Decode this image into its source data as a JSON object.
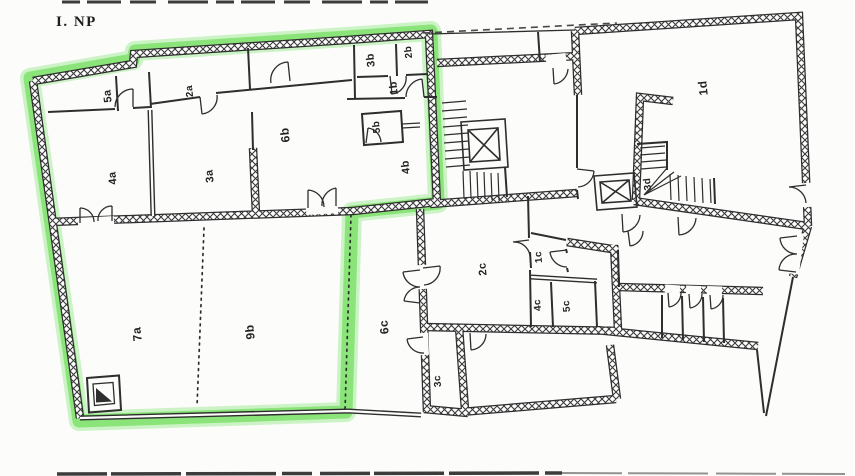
{
  "page": {
    "title": "I. NP"
  },
  "colors": {
    "paper": "#fcfcfb",
    "wall_ink": "#2e2e2e",
    "highlight_marker": "#7ee06b"
  },
  "symbols": {
    "elevator": "box-with-x",
    "stairs": "tread-lines",
    "door": "quarter-arc",
    "unit_boundary": "green-marker-outline",
    "room_divider": "dotted-line"
  },
  "rooms": [
    {
      "id": "5a",
      "label": "5a",
      "x": 108,
      "y": 96,
      "fs": 11
    },
    {
      "id": "2a",
      "label": "2a",
      "x": 190,
      "y": 91,
      "fs": 10
    },
    {
      "id": "4a",
      "label": "4a",
      "x": 113,
      "y": 178,
      "fs": 11
    },
    {
      "id": "3a",
      "label": "3a",
      "x": 210,
      "y": 176,
      "fs": 11
    },
    {
      "id": "6b",
      "label": "6b",
      "x": 285,
      "y": 135,
      "fs": 12
    },
    {
      "id": "3b",
      "label": "3b",
      "x": 371,
      "y": 60,
      "fs": 11
    },
    {
      "id": "2b",
      "label": "2b",
      "x": 409,
      "y": 52,
      "fs": 10
    },
    {
      "id": "1b",
      "label": "1b",
      "x": 394,
      "y": 88,
      "fs": 11
    },
    {
      "id": "5b",
      "label": "5b",
      "x": 377,
      "y": 127,
      "fs": 10
    },
    {
      "id": "4b",
      "label": "4b",
      "x": 406,
      "y": 167,
      "fs": 11
    },
    {
      "id": "1d",
      "label": "1d",
      "x": 703,
      "y": 88,
      "fs": 12
    },
    {
      "id": "3d",
      "label": "3d",
      "x": 648,
      "y": 184,
      "fs": 10
    },
    {
      "id": "2c",
      "label": "2c",
      "x": 483,
      "y": 269,
      "fs": 11
    },
    {
      "id": "1c",
      "label": "1c",
      "x": 539,
      "y": 257,
      "fs": 10
    },
    {
      "id": "4c",
      "label": "4c",
      "x": 538,
      "y": 305,
      "fs": 10
    },
    {
      "id": "5c",
      "label": "5c",
      "x": 567,
      "y": 306,
      "fs": 10
    },
    {
      "id": "7a",
      "label": "7a",
      "x": 137,
      "y": 334,
      "fs": 12
    },
    {
      "id": "9b",
      "label": "9b",
      "x": 250,
      "y": 332,
      "fs": 12
    },
    {
      "id": "6c",
      "label": "6c",
      "x": 384,
      "y": 327,
      "fs": 12
    },
    {
      "id": "3c",
      "label": "3c",
      "x": 438,
      "y": 381,
      "fs": 10
    }
  ]
}
